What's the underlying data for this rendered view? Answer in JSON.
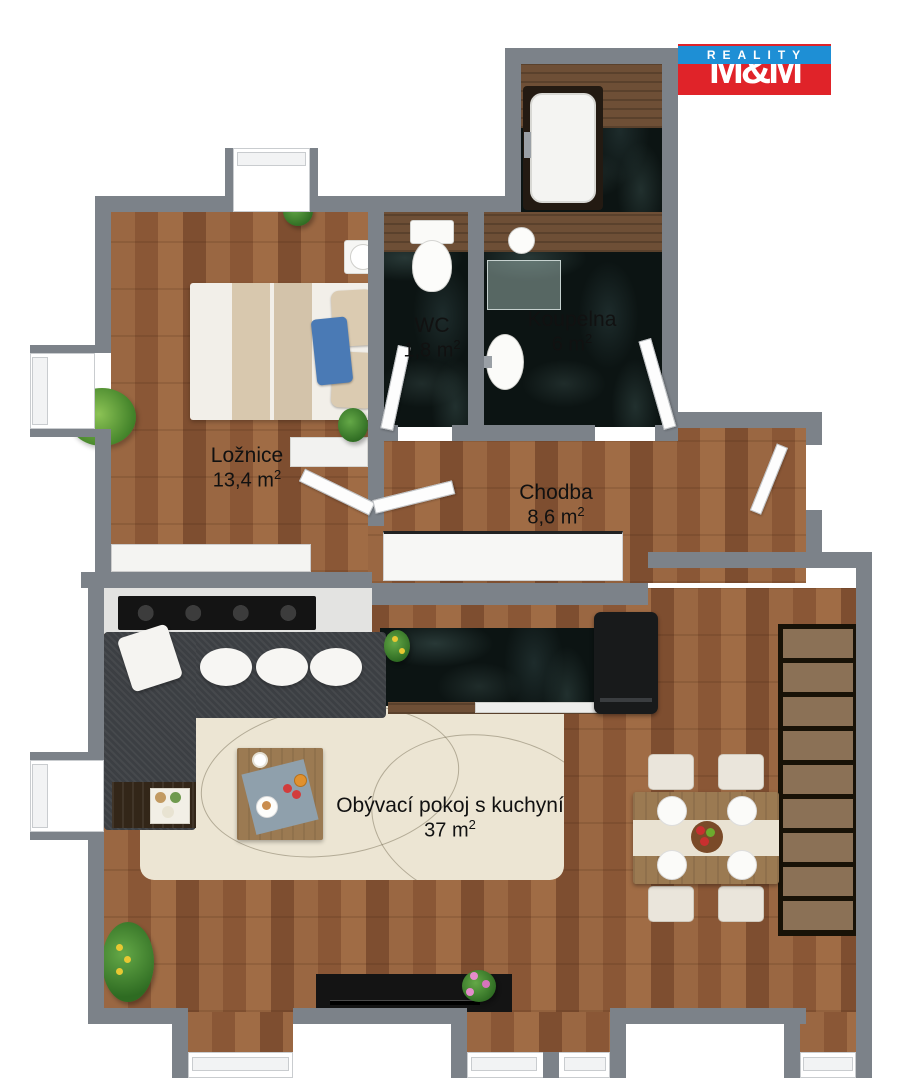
{
  "logo": {
    "top": "M&M",
    "bottom": "REALITY"
  },
  "rooms": {
    "loznice": {
      "name": "Ložnice",
      "area": "13,4 m",
      "area_exp": "2"
    },
    "wc": {
      "name": "WC",
      "area": "1,8 m",
      "area_exp": "2"
    },
    "koupelna": {
      "name": "Koupelna",
      "area": "6 m",
      "area_exp": "2"
    },
    "chodba": {
      "name": "Chodba",
      "area": "8,6 m",
      "area_exp": "2"
    },
    "obyvaci": {
      "name": "Obývací pokoj s kuchyní",
      "area": "37 m",
      "area_exp": "2"
    }
  },
  "colors": {
    "wall": "#7c8289",
    "wood1": "#9a6742",
    "wood2": "#8a5736",
    "wood3": "#a06c45",
    "wood4": "#7e4e30",
    "marble": "#0c1413",
    "counterwood": "#6e4f36",
    "sofa": "#3c3f43",
    "rug": "#ece5d3",
    "linen": "#f2efe9",
    "beige": "#d8c8ae",
    "bluepillow": "#4a7ab5",
    "tablewood": "#9b7a52",
    "cream": "#eae5db",
    "stair": "#8b7156",
    "blackfurn": "#141414",
    "logored": "#e02329",
    "logoblue": "#1e8fd5"
  }
}
